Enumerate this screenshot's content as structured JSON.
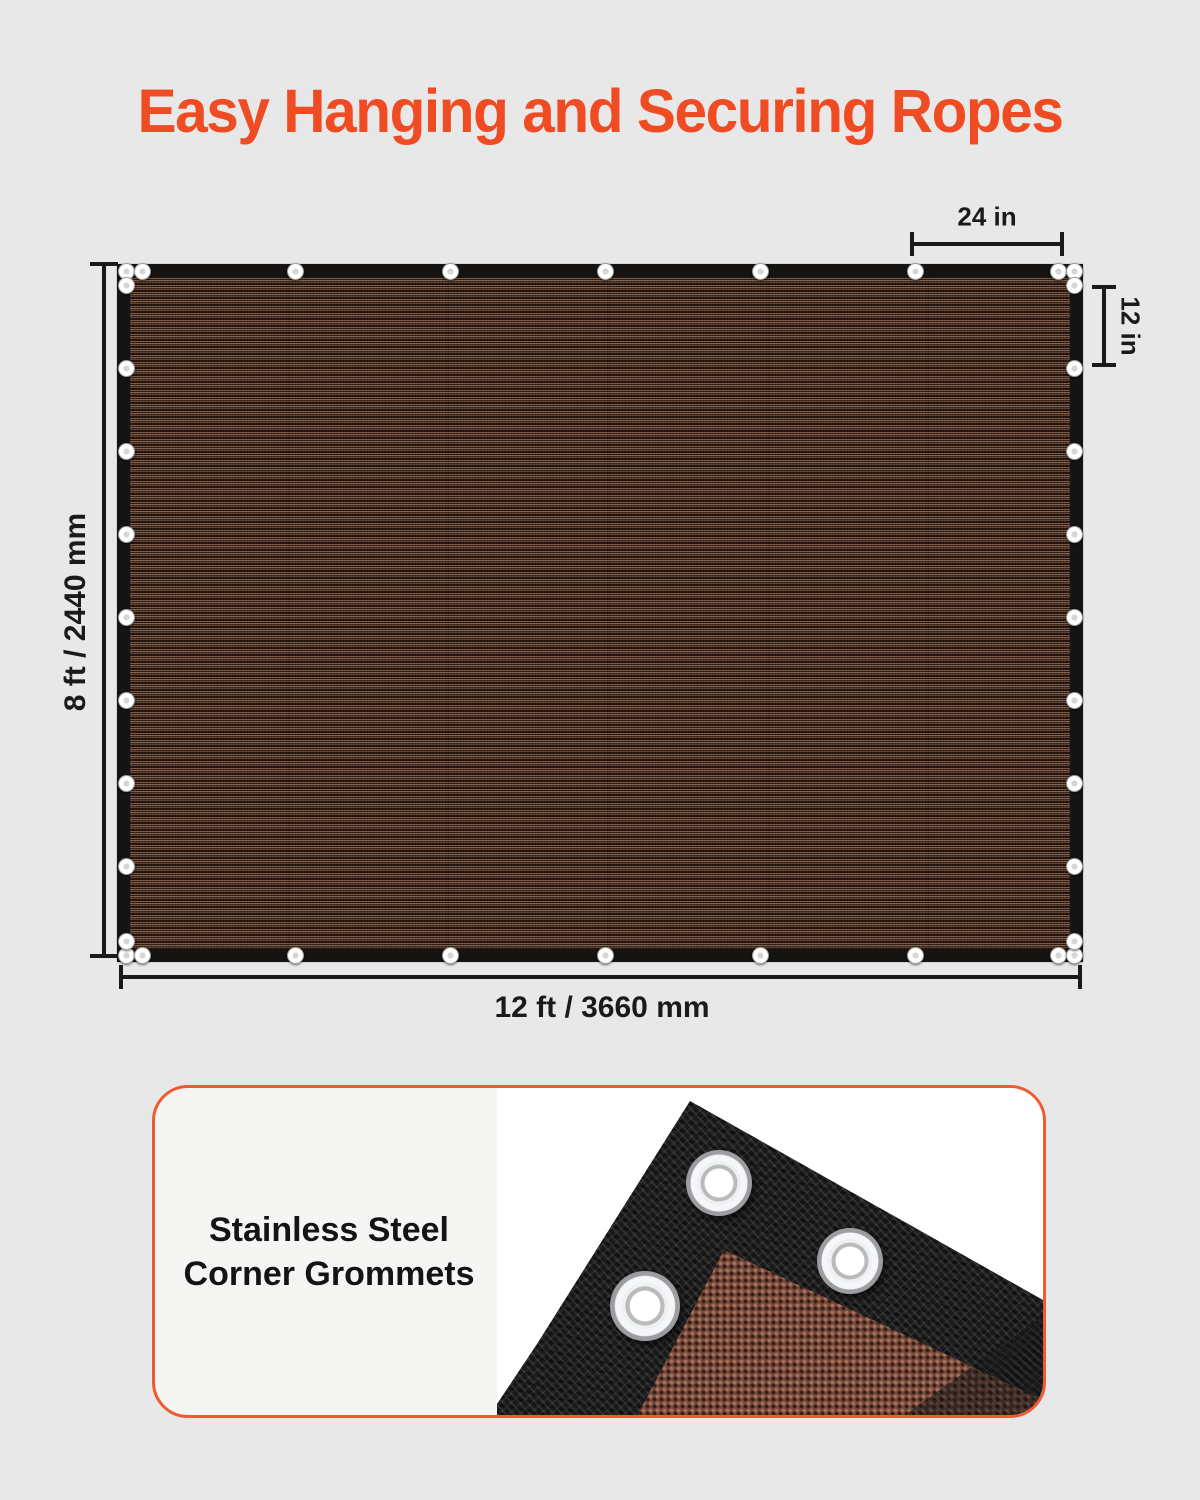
{
  "title": {
    "text": "Easy Hanging and Securing Ropes"
  },
  "dimensions": {
    "width_label": "12 ft / 3660 mm",
    "height_label": "8 ft / 2440 mm",
    "grommet_spacing_horizontal_label": "24 in",
    "grommet_spacing_vertical_label": "12 in"
  },
  "feature_card": {
    "line1": "Stainless Steel",
    "line2": "Corner Grommets"
  },
  "icons": {
    "panel_grommet": "grommet-icon",
    "photo_grommet": "grommet-icon"
  },
  "colors": {
    "accent": "#F04C24",
    "card_border": "#EE5B30",
    "bg": "#E9E8E8",
    "dim": "#1A1A1A",
    "panel_border": "#161412",
    "mesh_brown": "#4A3328"
  }
}
